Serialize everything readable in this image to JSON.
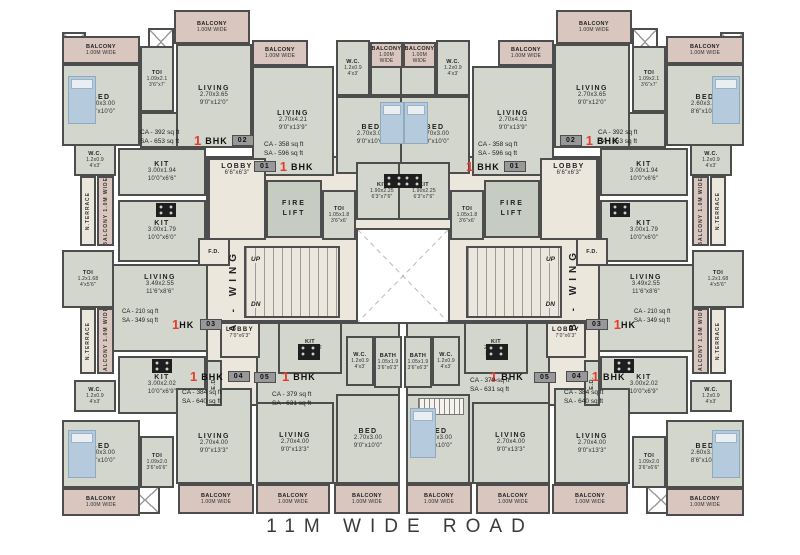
{
  "road": "11M WIDE ROAD",
  "wings": {
    "a": "A - WING",
    "b": "B - WING"
  },
  "core": {
    "lobby_a": {
      "name": "LOBBY",
      "dim": "6'6\"x6'3\""
    },
    "lobby_b": {
      "name": "LOBBY",
      "dim": "7'0\"x6'3\""
    },
    "fire_lift": "FIRE LIFT",
    "fd": "F.D.",
    "ed": "E.D.",
    "up": "UP",
    "dn": "DN"
  },
  "rooms": {
    "bed_s": {
      "name": "BED",
      "m": "2.60x3.00",
      "ft": "8'6\"x10'0\""
    },
    "bed_m": {
      "name": "BED",
      "m": "2.70x3.00",
      "ft": "9'0\"x10'0\""
    },
    "liv_120": {
      "name": "LIVING",
      "m": "2.70x3.65",
      "ft": "9'0\"x12'0\""
    },
    "liv_139": {
      "name": "LIVING",
      "m": "2.70x4.21",
      "ft": "9'0\"x13'9\""
    },
    "liv_133": {
      "name": "LIVING",
      "m": "2.70x4.00",
      "ft": "9'0\"x13'3\""
    },
    "liv_hk": {
      "name": "LIVING",
      "m": "3.49x2.55",
      "ft": "11'6\"x8'6\""
    },
    "kit_66": {
      "name": "KIT",
      "m": "3.00x1.94",
      "ft": "10'0\"x6'6\""
    },
    "kit_60": {
      "name": "KIT",
      "m": "3.00x1.79",
      "ft": "10'0\"x6'0\""
    },
    "kit_69": {
      "name": "KIT",
      "m": "3.00x2.02",
      "ft": "10'0\"x6'9\""
    },
    "kit_76": {
      "name": "KIT",
      "m": "1.90x2.25",
      "ft": "6'3\"x7'6\""
    },
    "kit_63": {
      "name": "KIT",
      "m": "2.40x1.92",
      "ft": "8'0\"x6'3\""
    },
    "toi_70": {
      "name": "TOI",
      "m": "1.09x2.1",
      "ft": "3'6\"x7'"
    },
    "toi_56": {
      "name": "TOI",
      "m": "1.2x1.68",
      "ft": "4'x5'6\""
    },
    "toi_60": {
      "name": "TOI",
      "m": "1.05x1.8",
      "ft": "3'6\"x6'"
    },
    "toi_66": {
      "name": "TOI",
      "m": "1.09x2.0",
      "ft": "3'6\"x6'6\""
    },
    "wc": {
      "name": "W.C.",
      "m": "1.2x0.9",
      "ft": "4'x3'"
    },
    "bath": {
      "name": "BATH",
      "m": "1.05x1.9",
      "ft": "3'6\"x6'3\""
    },
    "balcony": {
      "name": "BALCONY",
      "sub": "1.00M WIDE"
    },
    "balcony_v": "BALCONY 1.0M WIDE",
    "terrace": "N.TERRACE"
  },
  "units": {
    "u1": {
      "num": "1",
      "type": "BHK",
      "badge": "01",
      "ca": "CA - 358 sq ft",
      "sa": "SA - 596 sq ft"
    },
    "u2": {
      "num": "1",
      "type": "BHK",
      "badge": "02",
      "ca": "CA - 392 sq ft",
      "sa": "SA - 653 sq ft"
    },
    "u3": {
      "num": "1",
      "type": "HK",
      "badge": "03",
      "ca": "CA - 210 sq ft",
      "sa": "SA - 349 sq ft"
    },
    "u4": {
      "num": "1",
      "type": "BHK",
      "badge": "04",
      "ca": "CA - 384 sq ft",
      "sa": "SA - 640 sq ft"
    },
    "u5": {
      "num": "1",
      "type": "BHK",
      "badge": "05",
      "ca": "CA - 379 sq ft",
      "sa": "SA - 631 sq ft"
    }
  },
  "colors": {
    "wall": "#4d4d4d",
    "room_fill": "#d3d6cd",
    "balcony_fill": "#d9c7bf",
    "core_fill": "#ebe7dd",
    "shaft_fill": "#ffffff",
    "accent_red": "#e8392a"
  }
}
